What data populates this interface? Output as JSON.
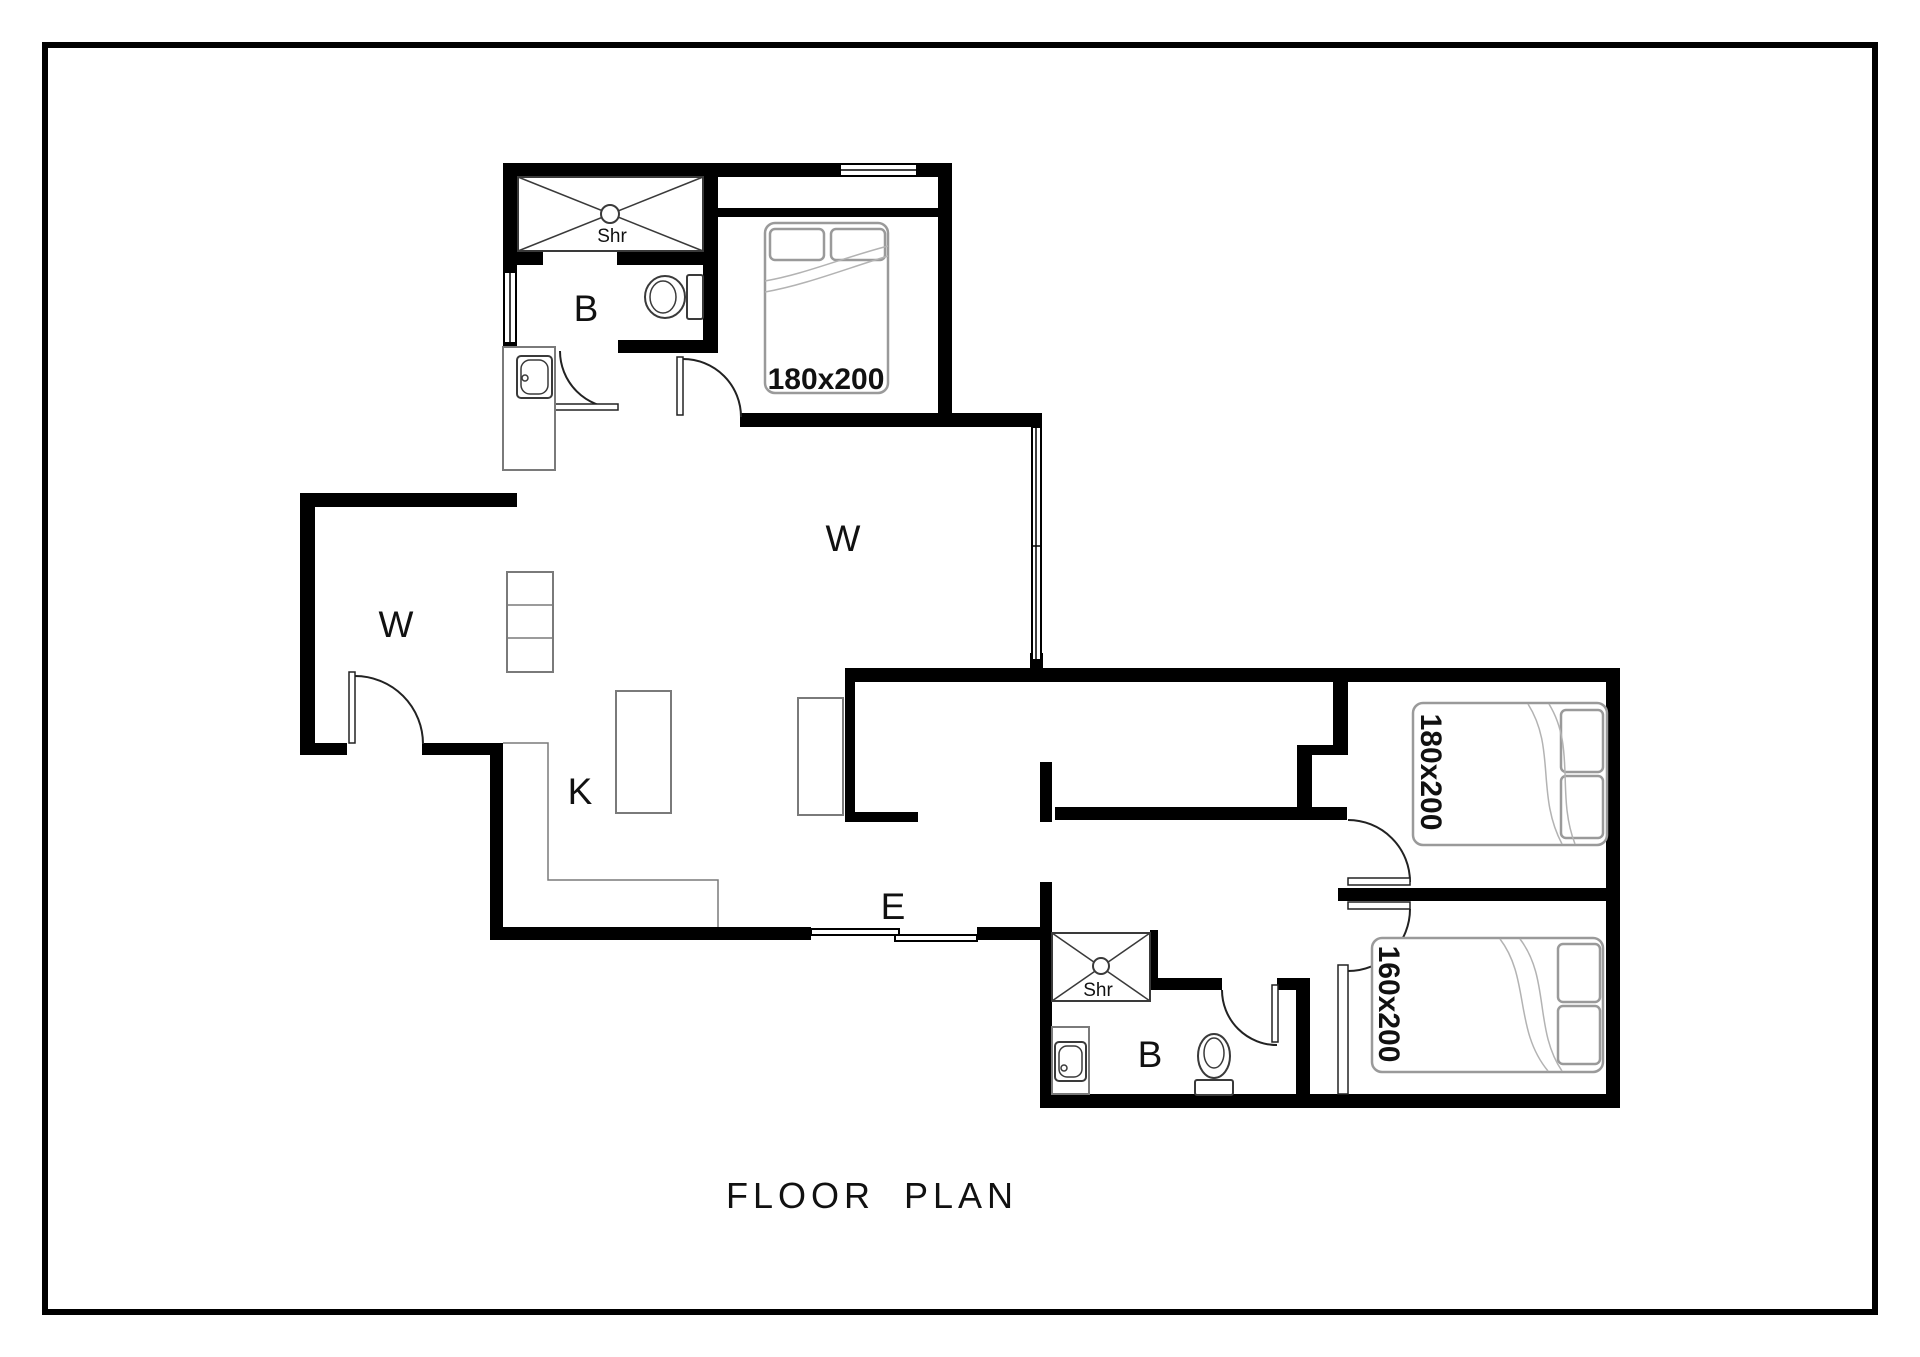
{
  "title": {
    "label": "FLOOR PLAN"
  },
  "colors": {
    "wall": "#000000",
    "background": "#ffffff",
    "door_line": "#222222",
    "fixture_line": "#3a3a3a",
    "furniture_line": "#7a7a7a",
    "bed_line": "#9a9a9a",
    "label_text": "#111111"
  },
  "rooms": {
    "living": {
      "label": "W"
    },
    "left_room": {
      "label": "W"
    },
    "kitchen": {
      "label": "K"
    },
    "entry": {
      "label": "E"
    },
    "bath_top": {
      "label": "B"
    },
    "bath_bottom": {
      "label": "B"
    }
  },
  "fixtures": {
    "shower_top": {
      "label": "Shr"
    },
    "shower_bottom": {
      "label": "Shr"
    }
  },
  "beds": {
    "master": {
      "size_label": "180x200"
    },
    "bedroom_right_top": {
      "size_label": "180x200"
    },
    "bedroom_right_bottom": {
      "size_label": "160x200"
    }
  }
}
